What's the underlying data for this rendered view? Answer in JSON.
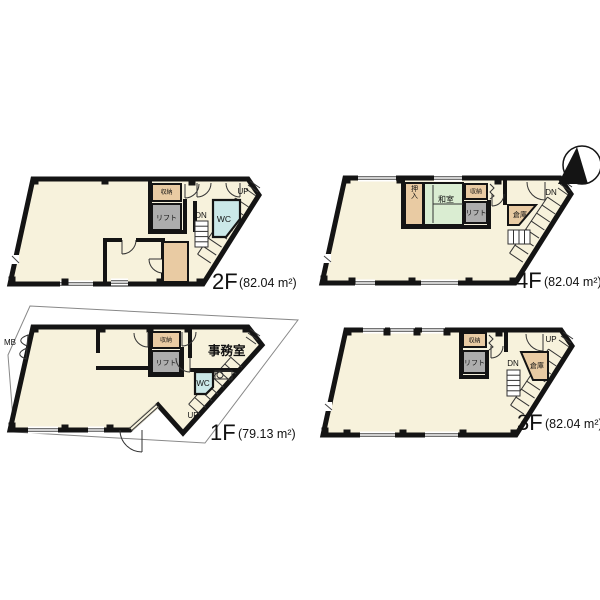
{
  "document": {
    "type": "building-floor-plan",
    "background": "#ffffff"
  },
  "colors": {
    "floor_fill": "#F7F2DC",
    "storage_fill": "#E9CBA3",
    "lift_fill": "#ADADAD",
    "wc_fill": "#CBE8E8",
    "tatami_fill": "#DAEDD2",
    "wall": "#141414"
  },
  "compass": {
    "icon": "north-arrow"
  },
  "floors": {
    "f2": {
      "name": "2F",
      "area": "(82.04 m²)",
      "labels": {
        "storage": "収納",
        "lift": "リフト",
        "wc": "WC",
        "dn": "DN",
        "up": "UP"
      }
    },
    "f4": {
      "name": "4F",
      "area": "(82.04 m²)",
      "labels": {
        "oshiire": "押入",
        "washitsu": "和室",
        "storage": "収納",
        "lift": "リフト",
        "souko": "倉庫",
        "dn": "DN"
      }
    },
    "f1": {
      "name": "1F",
      "area": "(79.13 m²)",
      "labels": {
        "mb": "MB",
        "storage": "収納",
        "lift": "リフト",
        "office": "事務室",
        "wc": "WC",
        "up": "UP"
      }
    },
    "f3": {
      "name": "3F",
      "area": "(82.04 m²)",
      "labels": {
        "storage": "収納",
        "lift": "リフト",
        "souko": "倉庫",
        "dn": "DN",
        "up": "UP"
      }
    }
  }
}
